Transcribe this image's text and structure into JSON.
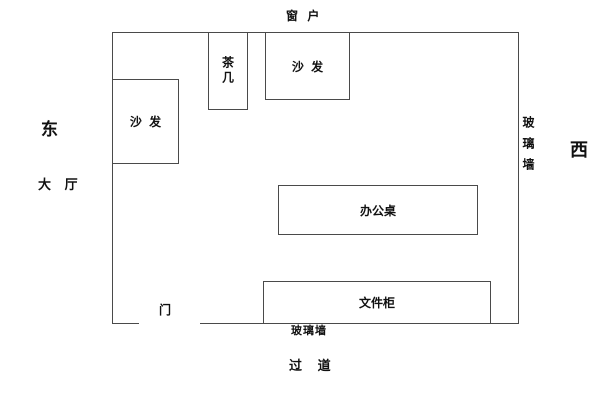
{
  "page": {
    "background_color": "#ffffff",
    "line_color": "#4a4a4a",
    "text_color": "#111111"
  },
  "compass": {
    "east_label": "东",
    "west_label": "西"
  },
  "exterior": {
    "window_label": "窗 户",
    "lobby_label": "大 厅",
    "door_label": "门",
    "glass_wall_right_label": "玻璃墙",
    "glass_wall_bottom_label": "玻璃墙",
    "aisle_label": "过 道"
  },
  "room": {
    "furniture": {
      "sofa_left_label": "沙 发",
      "tea_table_label": "茶几",
      "sofa_top_label": "沙 发",
      "desk_label": "办公桌",
      "cabinet_label": "文件柜"
    }
  }
}
